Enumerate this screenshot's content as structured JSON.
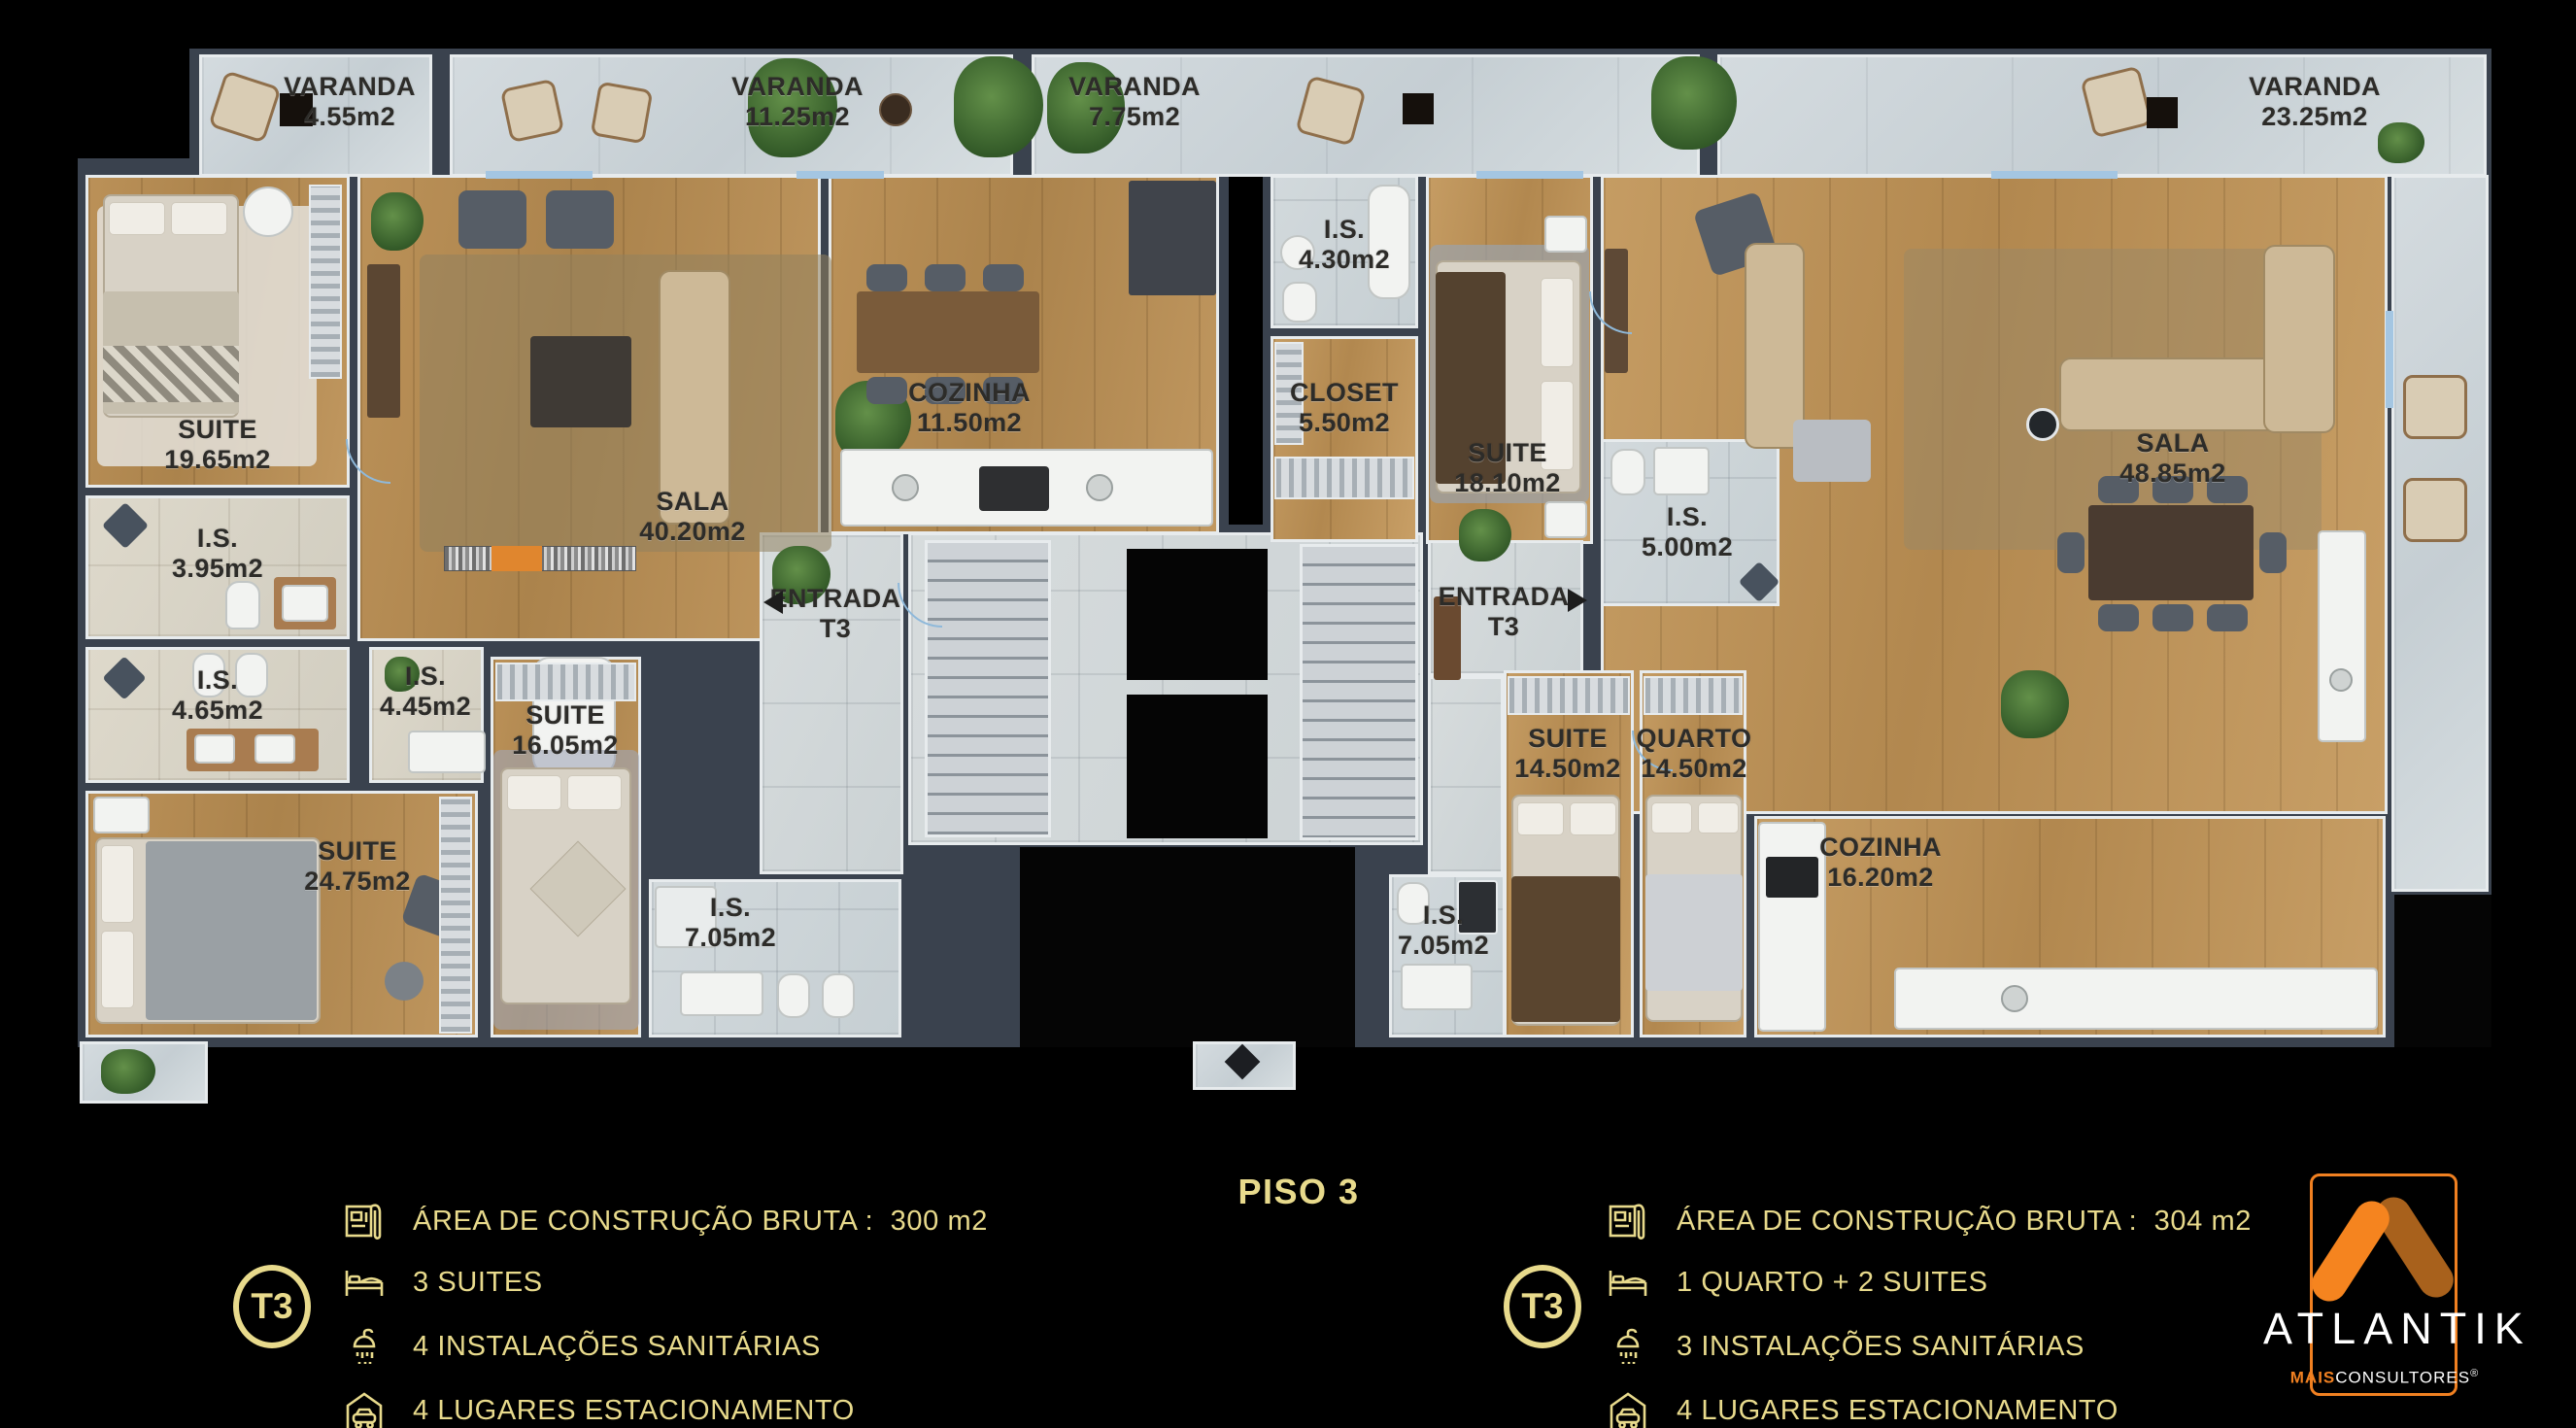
{
  "title": {
    "floor": "PISO 3"
  },
  "balconies": [
    {
      "name": "VARANDA",
      "area": "4.55m2"
    },
    {
      "name": "VARANDA",
      "area": "11.25m2"
    },
    {
      "name": "VARANDA",
      "area": "7.75m2"
    },
    {
      "name": "VARANDA",
      "area": "23.25m2"
    }
  ],
  "la": {
    "suite19": {
      "label": "SUITE",
      "area": "19.65m2"
    },
    "is395": {
      "label": "I.S.",
      "area": "3.95m2"
    },
    "is465": {
      "label": "I.S.",
      "area": "4.65m2"
    },
    "suite24": {
      "label": "SUITE",
      "area": "24.75m2"
    },
    "is445": {
      "label": "I.S.",
      "area": "4.45m2"
    },
    "suite16": {
      "label": "SUITE",
      "area": "16.05m2"
    },
    "sala": {
      "label": "SALA",
      "area": "40.20m2"
    },
    "cozinha": {
      "label": "COZINHA",
      "area": "11.50m2"
    },
    "entrada": {
      "label": "ENTRADA",
      "area": "T3"
    },
    "is705": {
      "label": "I.S.",
      "area": "7.05m2"
    }
  },
  "ra": {
    "is430": {
      "label": "I.S.",
      "area": "4.30m2"
    },
    "closet": {
      "label": "CLOSET",
      "area": "5.50m2"
    },
    "suite18": {
      "label": "SUITE",
      "area": "18.10m2"
    },
    "is500": {
      "label": "I.S.",
      "area": "5.00m2"
    },
    "sala": {
      "label": "SALA",
      "area": "48.85m2"
    },
    "entrada": {
      "label": "ENTRADA",
      "area": "T3"
    },
    "is705": {
      "label": "I.S.",
      "area": "7.05m2"
    },
    "suite14": {
      "label": "SUITE",
      "area": "14.50m2"
    },
    "quarto": {
      "label": "QUARTO",
      "area": "14.50m2"
    },
    "cozinha": {
      "label": "COZINHA",
      "area": "16.20m2"
    }
  },
  "legend_left": {
    "unit": "T3",
    "area_label": "ÁREA DE CONSTRUÇÃO BRUTA :",
    "area_value": "300 m2",
    "bedrooms": "3 SUITES",
    "bathrooms": "4 INSTALAÇÕES SANITÁRIAS",
    "parking": "4 LUGARES ESTACIONAMENTO"
  },
  "legend_right": {
    "unit": "T3",
    "area_label": "ÁREA DE CONSTRUÇÃO BRUTA :",
    "area_value": "304 m2",
    "bedrooms": "1 QUARTO + 2 SUITES",
    "bathrooms": "3 INSTALAÇÕES SANITÁRIAS",
    "parking": "4 LUGARES ESTACIONAMENTO"
  },
  "logo": {
    "brand": "ATLANTIK",
    "tagline_bold": "MAIS",
    "tagline_rest": "CONSULTORES",
    "registered": "®"
  },
  "colors": {
    "accent_gold": "#e8da8c",
    "brand_orange": "#f08021",
    "wall": "#3a424e"
  }
}
